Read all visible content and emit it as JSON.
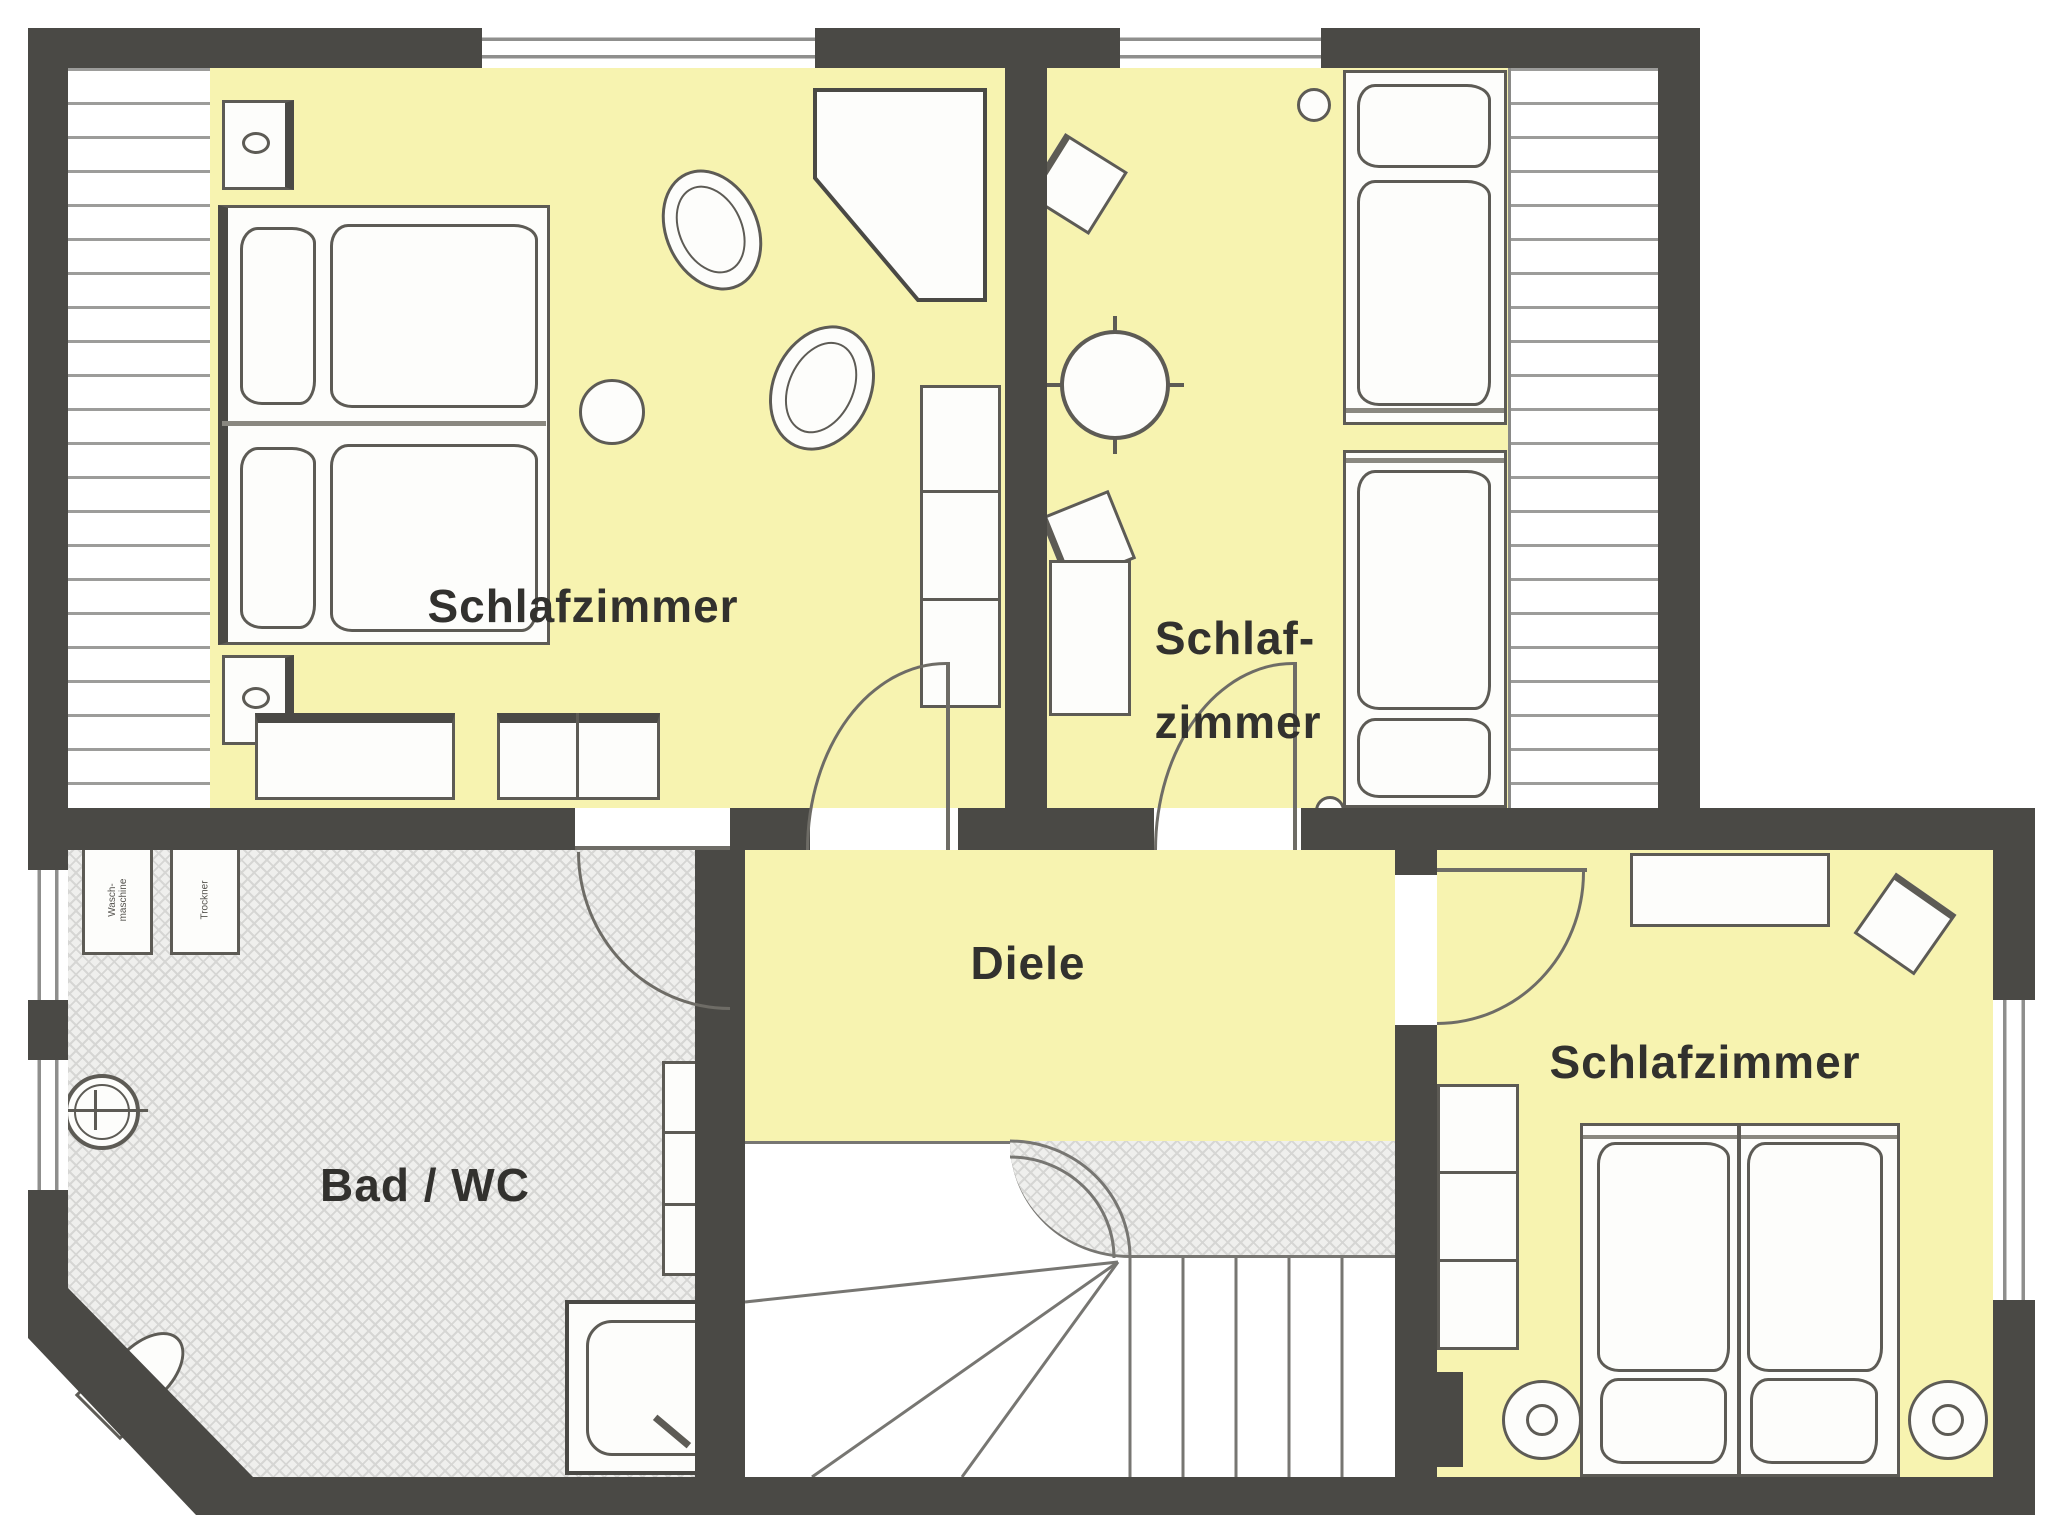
{
  "floorplan": {
    "rooms": {
      "bedroom_top_left": {
        "label": "Schlafzimmer"
      },
      "bedroom_top_right": {
        "label_line1": "Schlaf-",
        "label_line2": "zimmer"
      },
      "bathroom": {
        "label": "Bad / WC",
        "washer_line1": "Wasch-",
        "washer_line2": "maschine",
        "dryer": "Trockner"
      },
      "hallway": {
        "label": "Diele"
      },
      "bedroom_bottom_right": {
        "label": "Schlafzimmer"
      }
    },
    "colors": {
      "wall": "#4a4945",
      "room_fill": "#f7f3b0",
      "bathroom_floor": "#efefed",
      "furniture_outline": "#5d5b55",
      "label_text": "#32312e"
    }
  }
}
